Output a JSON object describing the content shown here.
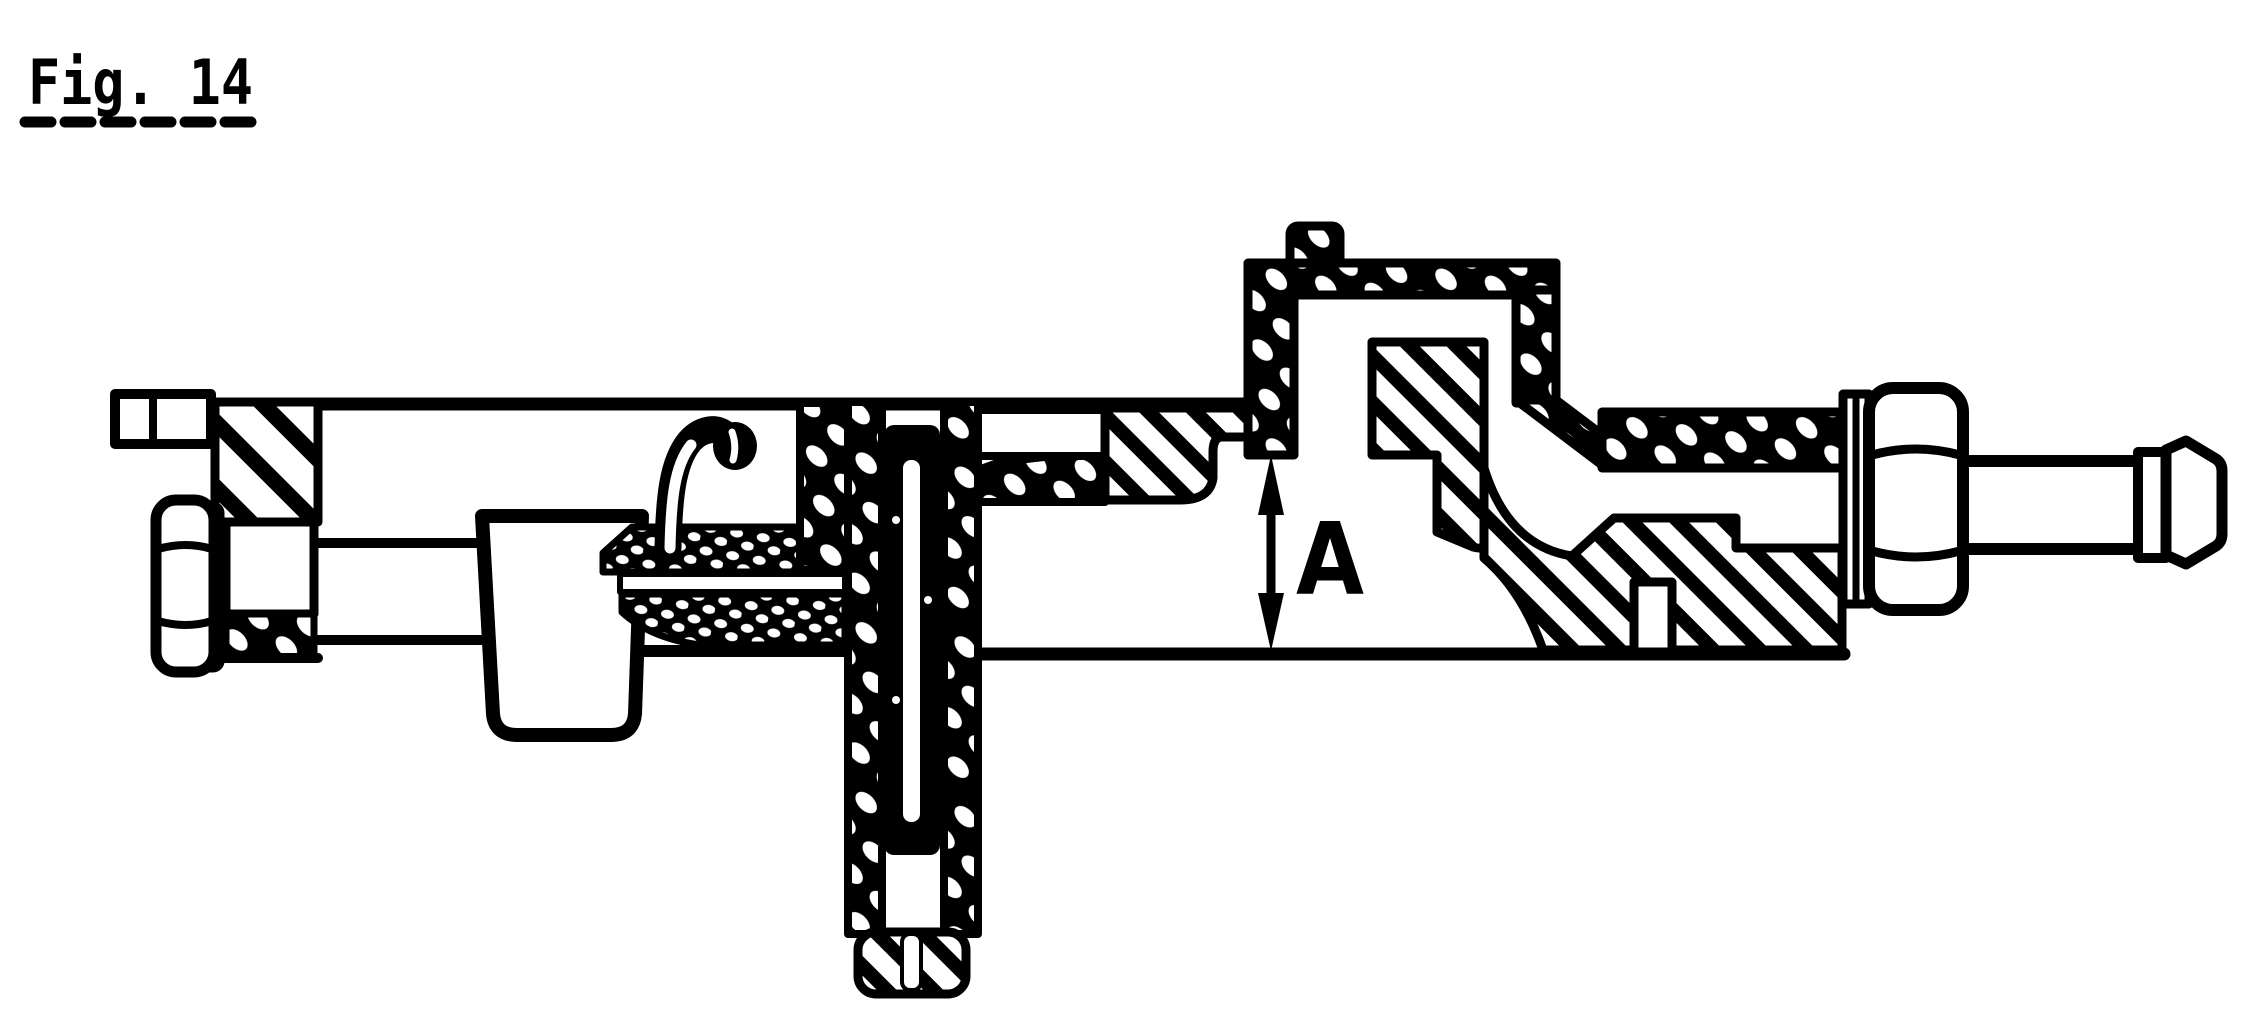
{
  "figure": {
    "label": "Fig. 14",
    "dimension_label": "A"
  },
  "colors": {
    "ink": "#000000",
    "paper": "#ffffff"
  }
}
